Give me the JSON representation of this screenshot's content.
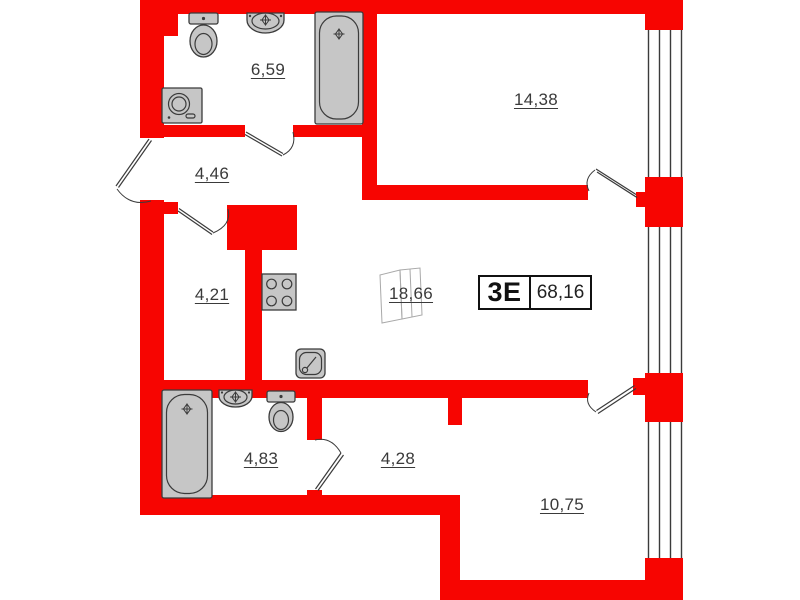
{
  "plan": {
    "unit": {
      "type": "3Е",
      "total_area": "68,16"
    },
    "rooms": [
      {
        "id": "bathroom-top",
        "area": "6,59"
      },
      {
        "id": "bedroom-top",
        "area": "14,38"
      },
      {
        "id": "hallway",
        "area": "4,46"
      },
      {
        "id": "storage",
        "area": "4,21"
      },
      {
        "id": "kitchen-living",
        "area": "18,66"
      },
      {
        "id": "bathroom-bottom",
        "area": "4,83"
      },
      {
        "id": "corridor",
        "area": "4,28"
      },
      {
        "id": "bedroom-bottom",
        "area": "10,75"
      }
    ],
    "colors": {
      "wall": "#f70501",
      "line": "#3b3b3b",
      "fixture": "#c6c6c6",
      "text": "#3a3a3a",
      "background": "#ffffff"
    }
  }
}
